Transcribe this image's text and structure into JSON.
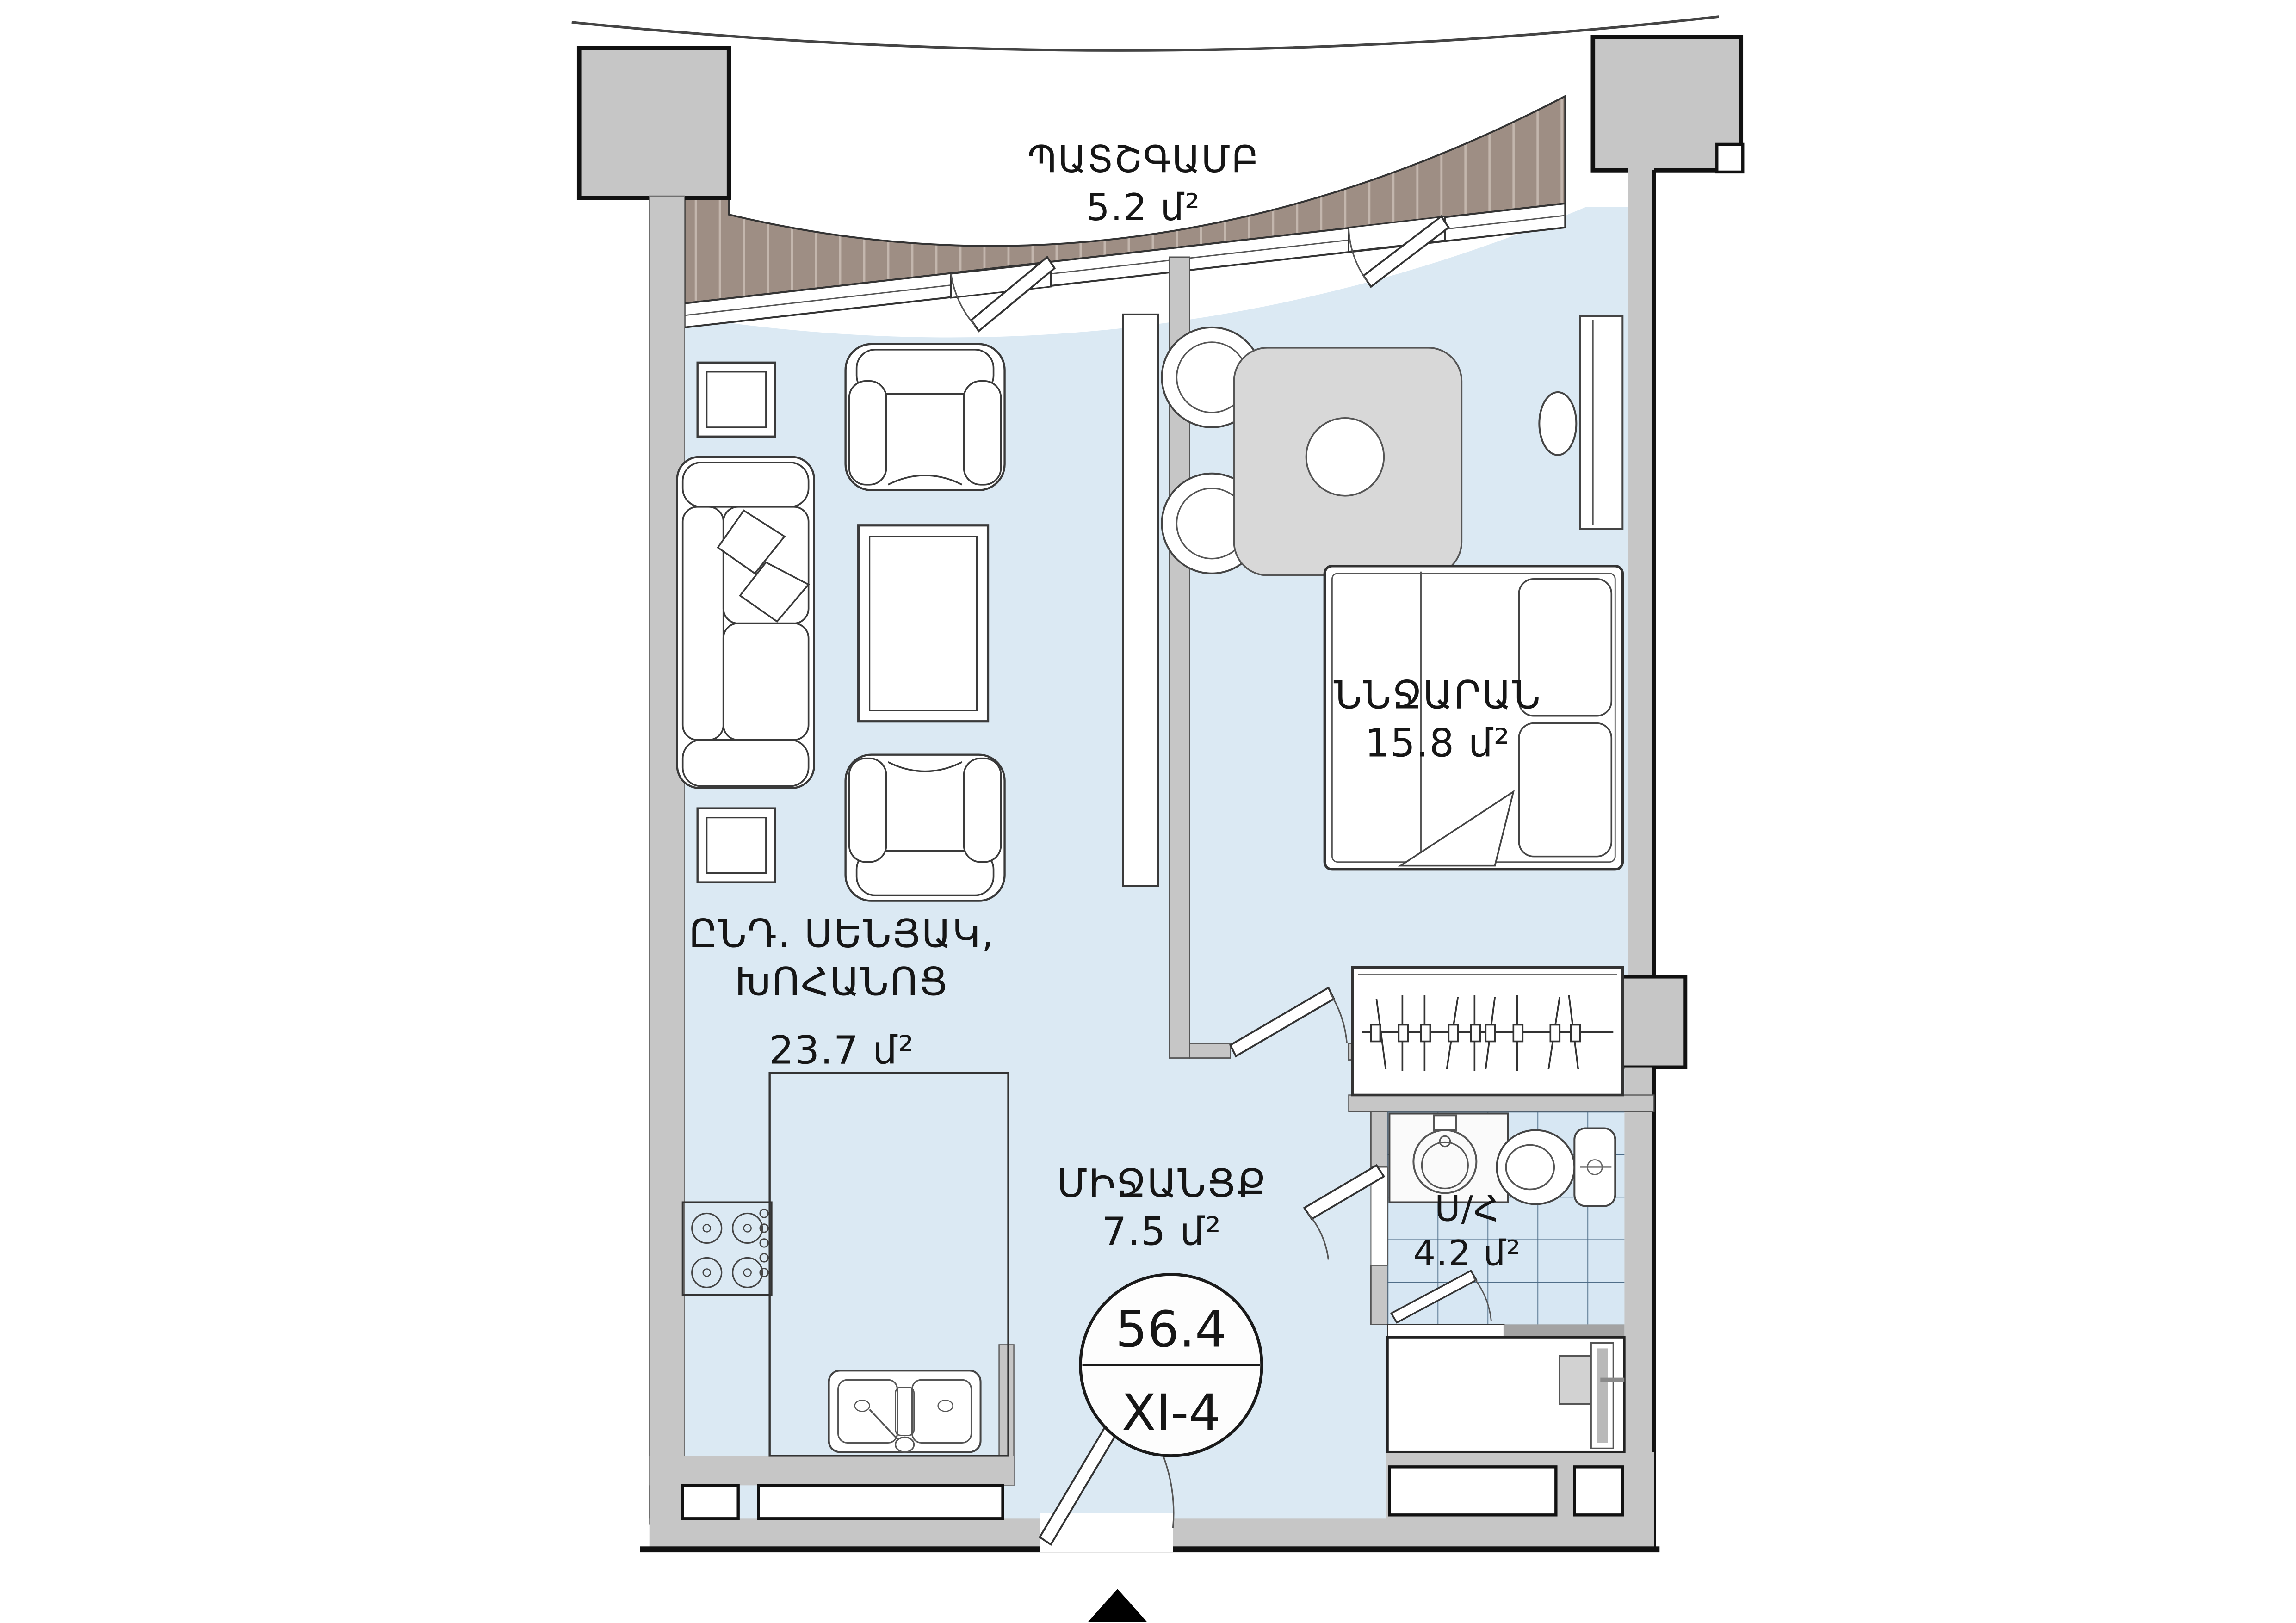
{
  "plan": {
    "type": "apartment-floor-plan",
    "rooms": {
      "balcony": {
        "name": "ՊԱՏՇԳԱՄԲ",
        "area": "5.2 մ²"
      },
      "living": {
        "name_line1": "ԸՆԴ. ՍԵՆՅԱԿ,",
        "name_line2": "ԽՈՀԱՆՈՑ",
        "area": "23.7 մ²"
      },
      "bedroom": {
        "name": "ՆՆՋԱՐԱՆ",
        "area": "15.8 մ²"
      },
      "hallway": {
        "name": "ՄԻՋԱՆՑՔ",
        "area": "7.5 մ²"
      },
      "bathroom": {
        "name": "Ս/Հ",
        "area": "4.2 մ²"
      }
    },
    "stamp": {
      "total_area": "56.4",
      "unit_id": "XI-4"
    },
    "colors": {
      "floor": "#dbe9f3",
      "wall": "#c6c6c6",
      "outline": "#111111",
      "balcony_deck": "#9e8e84",
      "balcony_stripe": "#c3b6ad",
      "tile_line": "#4a6a85",
      "furniture_fill": "#ffffff",
      "table_fill": "#d8d8d8"
    },
    "icons": {
      "entrance_marker": "north-entrance-triangle"
    }
  }
}
